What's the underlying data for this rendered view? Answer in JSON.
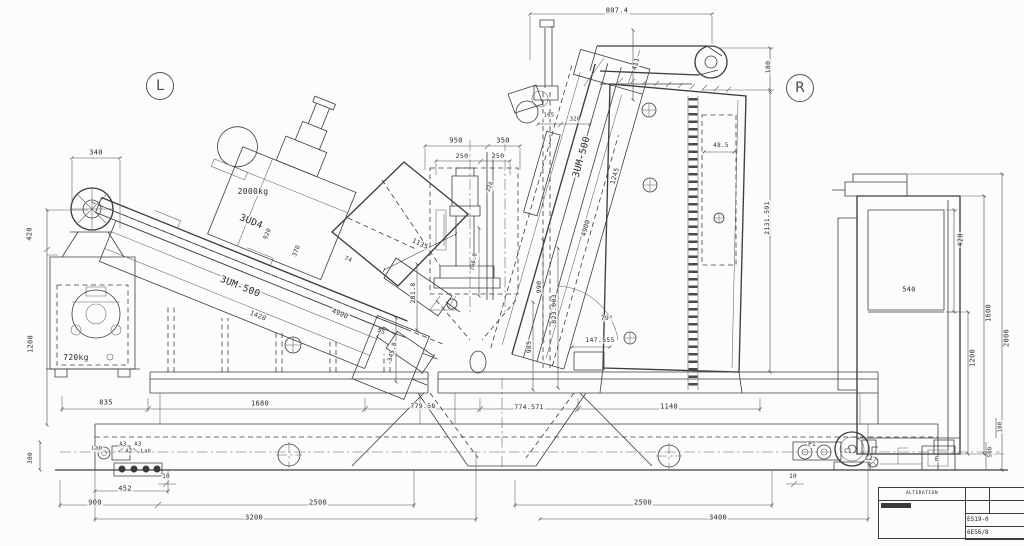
{
  "drawing_title": "3UM-500 twin-spindle machine installation drawing, side elevation",
  "view_markers": [
    {
      "label": "L",
      "x": 160,
      "y": 86
    },
    {
      "label": "R",
      "x": 800,
      "y": 88
    }
  ],
  "machine_models": [
    "3UM-500",
    "3UD4"
  ],
  "weights": [
    "2000kg",
    "720kg"
  ],
  "colors": {
    "paper": "#fcfcfa",
    "ink": "#3e3e3e"
  },
  "labels": [
    {
      "t": "807.4",
      "x": 617,
      "y": 11,
      "r": 0,
      "s": 7
    },
    {
      "t": "411",
      "x": 636,
      "y": 64,
      "r": -75,
      "s": 6.5
    },
    {
      "t": "180",
      "x": 768,
      "y": 67,
      "r": -90,
      "s": 6.5
    },
    {
      "t": "48.5",
      "x": 721,
      "y": 146,
      "r": 0,
      "s": 6
    },
    {
      "t": "2131.591",
      "x": 767,
      "y": 218,
      "r": -90,
      "s": 6.5
    },
    {
      "t": "165",
      "x": 549,
      "y": 116,
      "r": 0,
      "s": 5.5
    },
    {
      "t": "320",
      "x": 575,
      "y": 120,
      "r": 0,
      "s": 5.5
    },
    {
      "t": "3UM-500",
      "x": 582,
      "y": 157,
      "r": -74,
      "s": 9.5
    },
    {
      "t": "1245",
      "x": 615,
      "y": 176,
      "r": -74,
      "s": 6.5
    },
    {
      "t": "4900",
      "x": 586,
      "y": 228,
      "r": -74,
      "s": 6.5
    },
    {
      "t": "950",
      "x": 456,
      "y": 141,
      "r": 0,
      "s": 7
    },
    {
      "t": "350",
      "x": 503,
      "y": 141,
      "r": 0,
      "s": 7
    },
    {
      "t": "250",
      "x": 462,
      "y": 156,
      "r": 0,
      "s": 6.5
    },
    {
      "t": "250",
      "x": 498,
      "y": 156,
      "r": 0,
      "s": 6.5
    },
    {
      "t": "226",
      "x": 491,
      "y": 187,
      "r": -70,
      "s": 5.5
    },
    {
      "t": "1135",
      "x": 420,
      "y": 244,
      "r": 25,
      "s": 6.5
    },
    {
      "t": "990",
      "x": 539,
      "y": 287,
      "r": -90,
      "s": 6.5
    },
    {
      "t": "823.003",
      "x": 554,
      "y": 309,
      "r": -90,
      "s": 6.5
    },
    {
      "t": "985",
      "x": 529,
      "y": 347,
      "r": -90,
      "s": 6.5
    },
    {
      "t": "281.8",
      "x": 413,
      "y": 293,
      "r": -90,
      "s": 6.5
    },
    {
      "t": "766.0",
      "x": 475,
      "y": 262,
      "r": -80,
      "s": 5.5
    },
    {
      "t": "79°",
      "x": 607,
      "y": 318,
      "r": 0,
      "s": 6.5
    },
    {
      "t": "147.555",
      "x": 600,
      "y": 340,
      "r": 0,
      "s": 6.5
    },
    {
      "t": "345.8",
      "x": 393,
      "y": 352,
      "r": -75,
      "s": 6
    },
    {
      "t": "2000kg",
      "x": 253,
      "y": 192,
      "r": 0,
      "s": 8
    },
    {
      "t": "3UD4",
      "x": 251,
      "y": 222,
      "r": 22,
      "s": 9.5
    },
    {
      "t": "3UM-500",
      "x": 240,
      "y": 287,
      "r": 22,
      "s": 9.5
    },
    {
      "t": "1420",
      "x": 258,
      "y": 316,
      "r": 22,
      "s": 6.5
    },
    {
      "t": "4900",
      "x": 340,
      "y": 314,
      "r": 22,
      "s": 6.5
    },
    {
      "t": "55",
      "x": 381,
      "y": 332,
      "r": 22,
      "s": 6
    },
    {
      "t": "74",
      "x": 348,
      "y": 260,
      "r": 22,
      "s": 6
    },
    {
      "t": "370",
      "x": 297,
      "y": 251,
      "r": -68,
      "s": 6
    },
    {
      "t": "920",
      "x": 268,
      "y": 234,
      "r": -68,
      "s": 6
    },
    {
      "t": "720kg",
      "x": 76,
      "y": 358,
      "r": 0,
      "s": 8
    },
    {
      "t": "340",
      "x": 96,
      "y": 153,
      "r": 0,
      "s": 7
    },
    {
      "t": "420",
      "x": 30,
      "y": 234,
      "r": -90,
      "s": 7
    },
    {
      "t": "1200",
      "x": 31,
      "y": 344,
      "r": -90,
      "s": 7
    },
    {
      "t": "300",
      "x": 31,
      "y": 458,
      "r": -90,
      "s": 6
    },
    {
      "t": "835",
      "x": 106,
      "y": 403,
      "r": 0,
      "s": 7
    },
    {
      "t": "1680",
      "x": 260,
      "y": 404,
      "r": 0,
      "s": 7
    },
    {
      "t": "779.58",
      "x": 423,
      "y": 406,
      "r": 0,
      "s": 6.5
    },
    {
      "t": "774.571",
      "x": 529,
      "y": 407,
      "r": 0,
      "s": 6.5
    },
    {
      "t": "1140",
      "x": 669,
      "y": 407,
      "r": 0,
      "s": 7
    },
    {
      "t": "10",
      "x": 166,
      "y": 477,
      "r": 0,
      "s": 6
    },
    {
      "t": "452",
      "x": 125,
      "y": 489,
      "r": 0,
      "s": 7
    },
    {
      "t": "900",
      "x": 95,
      "y": 503,
      "r": 0,
      "s": 7
    },
    {
      "t": "2500",
      "x": 318,
      "y": 503,
      "r": 0,
      "s": 7
    },
    {
      "t": "3200",
      "x": 254,
      "y": 518,
      "r": 0,
      "s": 7
    },
    {
      "t": "10",
      "x": 793,
      "y": 477,
      "r": 0,
      "s": 6
    },
    {
      "t": "2500",
      "x": 643,
      "y": 503,
      "r": 0,
      "s": 7
    },
    {
      "t": "3400",
      "x": 718,
      "y": 518,
      "r": 0,
      "s": 7
    },
    {
      "t": "540",
      "x": 909,
      "y": 290,
      "r": 0,
      "s": 7
    },
    {
      "t": "420",
      "x": 961,
      "y": 240,
      "r": -90,
      "s": 7
    },
    {
      "t": "1200",
      "x": 973,
      "y": 358,
      "r": -90,
      "s": 7
    },
    {
      "t": "1600",
      "x": 989,
      "y": 313,
      "r": -90,
      "s": 7
    },
    {
      "t": "2000",
      "x": 1007,
      "y": 338,
      "r": -90,
      "s": 7
    },
    {
      "t": "100",
      "x": 1001,
      "y": 427,
      "r": -90,
      "s": 5.5
    },
    {
      "t": "500",
      "x": 991,
      "y": 452,
      "r": -90,
      "s": 5.5
    },
    {
      "t": "Lab",
      "x": 97,
      "y": 449,
      "r": 0,
      "s": 5.5
    },
    {
      "t": "A3",
      "x": 123,
      "y": 445,
      "r": 0,
      "s": 5.5
    },
    {
      "t": "A3",
      "x": 138,
      "y": 445,
      "r": 0,
      "s": 5.5
    },
    {
      "t": "A2",
      "x": 129,
      "y": 452,
      "r": 0,
      "s": 5.5
    },
    {
      "t": "Lab",
      "x": 146,
      "y": 452,
      "r": 0,
      "s": 5.5
    },
    {
      "t": "P1",
      "x": 812,
      "y": 445,
      "r": 0,
      "s": 6
    },
    {
      "t": "C1",
      "x": 848,
      "y": 452,
      "r": 0,
      "s": 6
    },
    {
      "t": "C2",
      "x": 869,
      "y": 459,
      "r": 0,
      "s": 6
    },
    {
      "t": "E",
      "x": 937,
      "y": 459,
      "r": 0,
      "s": 6.5
    }
  ],
  "title_block": {
    "header": "ALTERATION",
    "code": "ES19-0",
    "ref": "6E56/8"
  }
}
